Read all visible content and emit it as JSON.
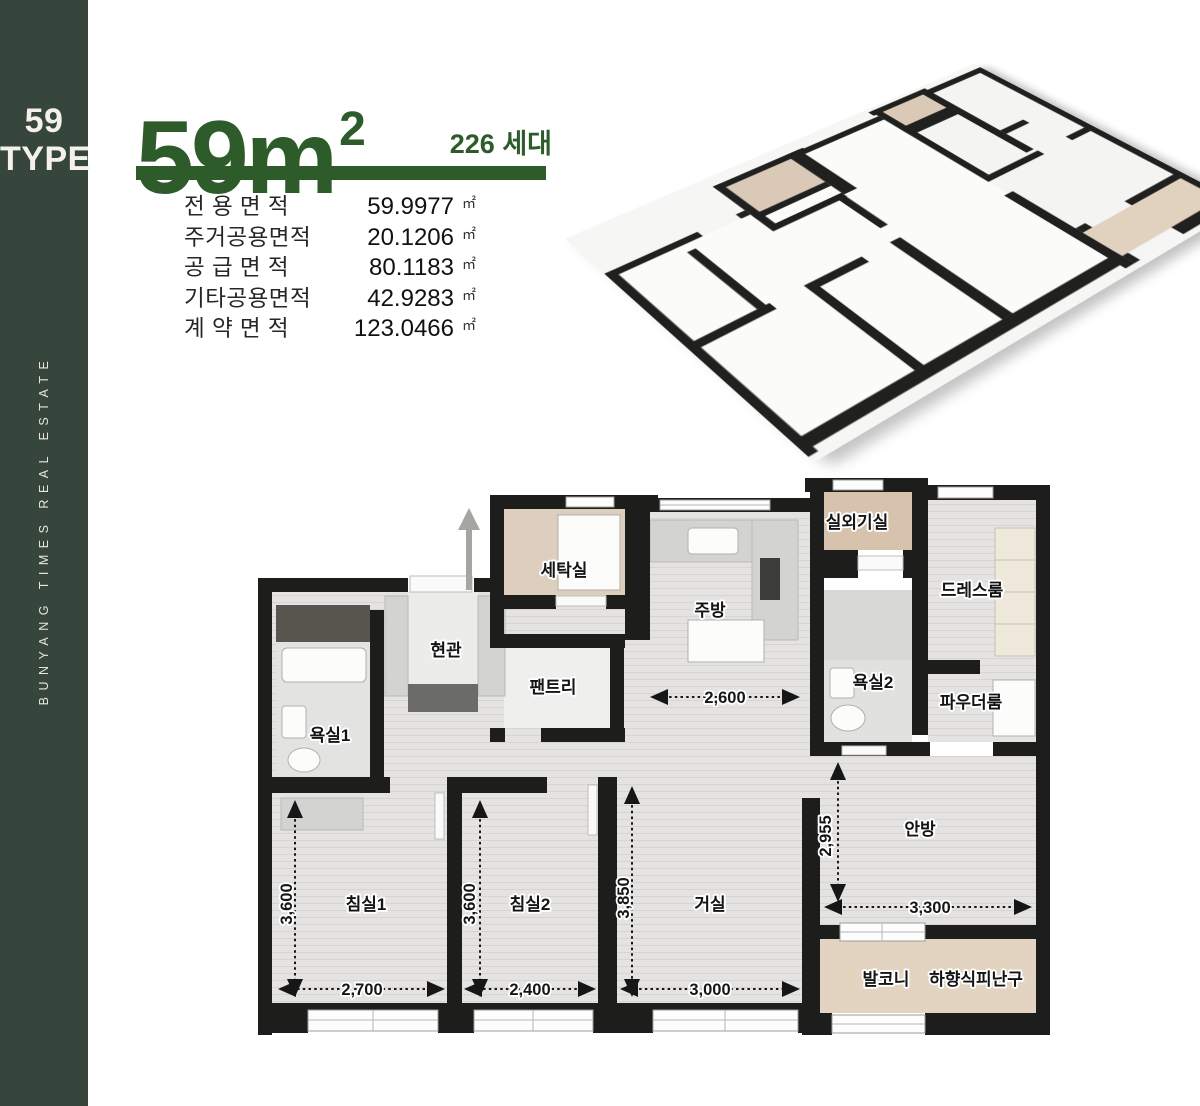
{
  "sidebar": {
    "type_number": "59",
    "type_word": "TYPE",
    "brand": "BUNYANG TIMES REAL ESTATE",
    "bg_color": "#37463d",
    "text_color": "#f4f1e9"
  },
  "header": {
    "area_title": "59m",
    "area_title_sup": "2",
    "units_count": "226 세대",
    "accent_color": "#2d5b2a"
  },
  "area_table": {
    "rows": [
      {
        "label": "전 용 면 적",
        "value": "59.9977",
        "unit": "㎡"
      },
      {
        "label": "주거공용면적",
        "value": "20.1206",
        "unit": "㎡"
      },
      {
        "label": "공 급 면 적",
        "value": "80.1183",
        "unit": "㎡"
      },
      {
        "label": "기타공용면적",
        "value": "42.9283",
        "unit": "㎡"
      },
      {
        "label": "계 약 면 적",
        "value": "123.0466",
        "unit": "㎡"
      }
    ]
  },
  "floorplan": {
    "wall_color": "#1d1d1b",
    "floor_color": "#e4e3e1",
    "accent_floor_color": "#d9c9b6",
    "rooms": [
      {
        "id": "laundry",
        "label": "세탁실"
      },
      {
        "id": "kitchen",
        "label": "주방"
      },
      {
        "id": "outdoor-unit",
        "label": "실외기실"
      },
      {
        "id": "dress-room",
        "label": "드레스룸"
      },
      {
        "id": "entrance",
        "label": "현관"
      },
      {
        "id": "pantry",
        "label": "팬트리"
      },
      {
        "id": "bathroom1",
        "label": "욕실1"
      },
      {
        "id": "bathroom2",
        "label": "욕실2"
      },
      {
        "id": "powder-room",
        "label": "파우더룸"
      },
      {
        "id": "bedroom1",
        "label": "침실1"
      },
      {
        "id": "bedroom2",
        "label": "침실2"
      },
      {
        "id": "living-room",
        "label": "거실"
      },
      {
        "id": "master-room",
        "label": "안방"
      },
      {
        "id": "balcony",
        "label": "발코니"
      },
      {
        "id": "escape-hatch",
        "label": "하향식피난구"
      }
    ],
    "dimensions": [
      {
        "id": "kitchen-width",
        "value": "2,600"
      },
      {
        "id": "master-depth",
        "value": "2,955"
      },
      {
        "id": "master-width",
        "value": "3,300"
      },
      {
        "id": "bedroom1-depth",
        "value": "3,600"
      },
      {
        "id": "bedroom1-width",
        "value": "2,700"
      },
      {
        "id": "bedroom2-depth",
        "value": "3,600"
      },
      {
        "id": "bedroom2-width",
        "value": "2,400"
      },
      {
        "id": "living-depth",
        "value": "3,850"
      },
      {
        "id": "living-width",
        "value": "3,000"
      }
    ]
  }
}
